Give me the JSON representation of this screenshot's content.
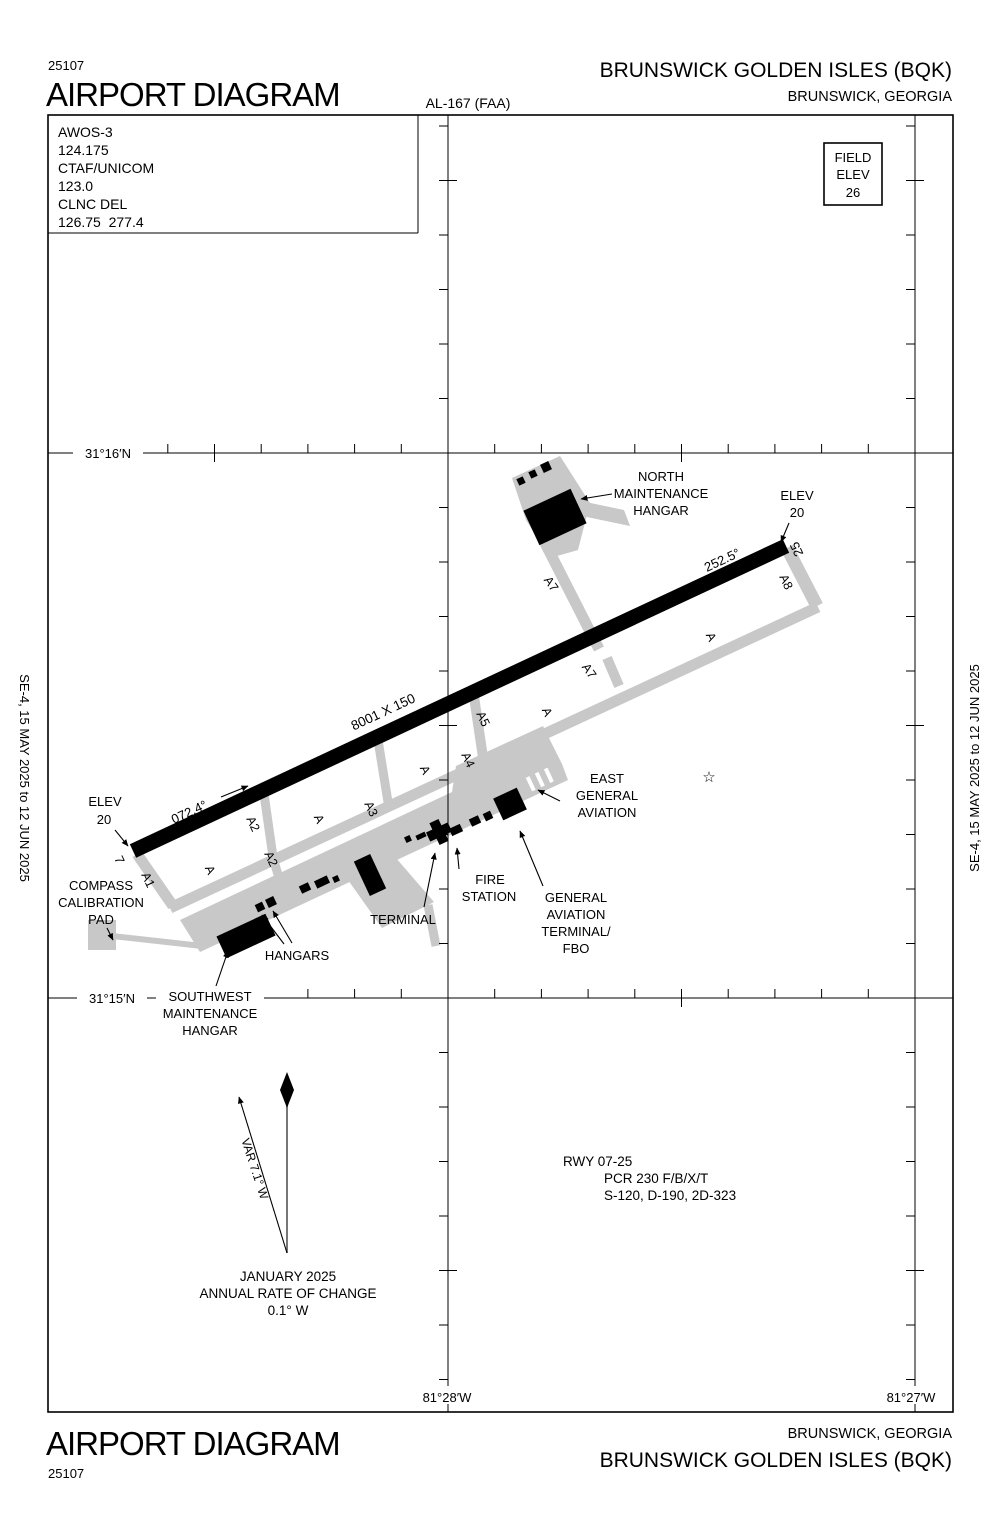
{
  "header": {
    "chart_code": "25107",
    "title": "AIRPORT DIAGRAM",
    "al_ref": "AL-167 (FAA)",
    "airport": "BRUNSWICK GOLDEN ISLES (BQK)",
    "city": "BRUNSWICK, GEORGIA"
  },
  "footer": {
    "title": "AIRPORT DIAGRAM",
    "chart_code": "25107",
    "airport": "BRUNSWICK GOLDEN ISLES (BQK)",
    "city": "BRUNSWICK, GEORGIA"
  },
  "margins": {
    "effective_dates": "SE-4,  15 MAY 2025  to  12 JUN 2025"
  },
  "comm": {
    "lines": [
      "AWOS-3",
      "124.175",
      "CTAF/UNICOM",
      "123.0",
      "CLNC DEL",
      "126.75  277.4"
    ]
  },
  "field_elev": {
    "lines": [
      "FIELD",
      "ELEV",
      "26"
    ]
  },
  "graticule": {
    "lat_n16": "31°16′N",
    "lat_n15": "31°15′N",
    "lon_w28": "81°28′W",
    "lon_w27": "81°27′W"
  },
  "runway": {
    "size": "8001 X 150",
    "hdg_sw": "072.4°",
    "hdg_ne": "252.5°",
    "num_sw": "7",
    "num_ne": "25"
  },
  "elev_ne": {
    "lines": [
      "ELEV",
      "20"
    ]
  },
  "elev_sw": {
    "lines": [
      "ELEV",
      "20"
    ]
  },
  "taxiway_labels": [
    "A1",
    "A2",
    "A2",
    "A3",
    "A4",
    "A5",
    "A7",
    "A7",
    "A8",
    "A",
    "A",
    "A",
    "A",
    "A"
  ],
  "facilities": {
    "north_hangar": [
      "NORTH",
      "MAINTENANCE",
      "HANGAR"
    ],
    "east_ga": [
      "EAST",
      "GENERAL",
      "AVIATION"
    ],
    "fire_station": [
      "FIRE",
      "STATION"
    ],
    "ga_terminal": [
      "GENERAL",
      "AVIATION",
      "TERMINAL/",
      "FBO"
    ],
    "terminal": "TERMINAL",
    "hangars": "HANGARS",
    "sw_hangar": [
      "SOUTHWEST",
      "MAINTENANCE",
      "HANGAR"
    ],
    "compass_pad": [
      "COMPASS",
      "CALIBRATION",
      "PAD"
    ]
  },
  "variation": {
    "var": "VAR 7.1° W",
    "date": "JANUARY 2025",
    "rate_label": "ANNUAL RATE OF CHANGE",
    "rate": "0.1° W"
  },
  "runway_data": {
    "lines": [
      "RWY 07-25",
      "PCR 230 F/B/X/T",
      "S-120, D-190, 2D-323"
    ]
  },
  "symbols": {
    "star": "☆"
  }
}
